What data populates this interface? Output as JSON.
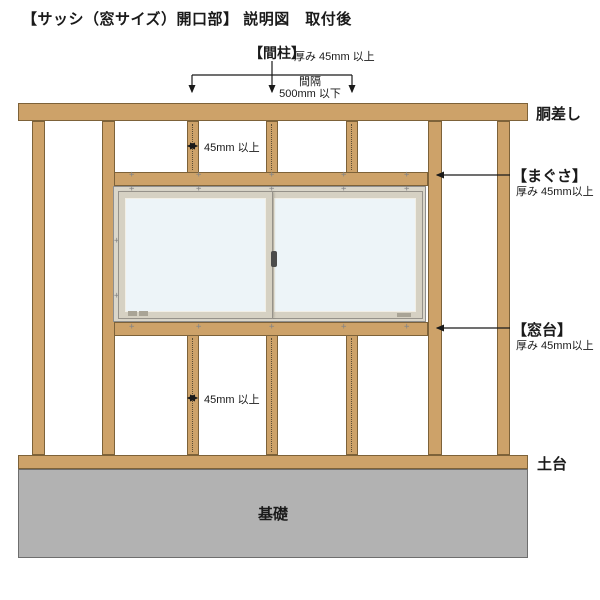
{
  "title": "【サッシ（窓サイズ）開口部】 説明図　取付後",
  "annotations": {
    "mabashira_label": "【間柱】",
    "mabashira_spec": "厚み 45mm 以上",
    "spacing_line1": "間隔",
    "spacing_line2": "500mm 以下",
    "stud_width_upper": "45mm 以上",
    "stud_width_lower": "45mm 以上",
    "girder_label": "胴差し",
    "lintel_label": "【まぐさ】",
    "lintel_spec": "厚み 45mm以上",
    "windowsill_label": "【窓台】",
    "windowsill_spec": "厚み 45mm以上",
    "base_label": "土台",
    "foundation_label": "基礎"
  },
  "icons": {
    "nail_mark": "+"
  },
  "colors": {
    "wood": "#CDA269",
    "wood-border": "#7D6239",
    "foundation": "#B2B2B2",
    "foundation-border": "#6E6E6E",
    "frame": "#DAD6CA",
    "sash": "#D6D1C3",
    "glass": "#EDF4F8",
    "annotation": "#1A1A1A"
  }
}
